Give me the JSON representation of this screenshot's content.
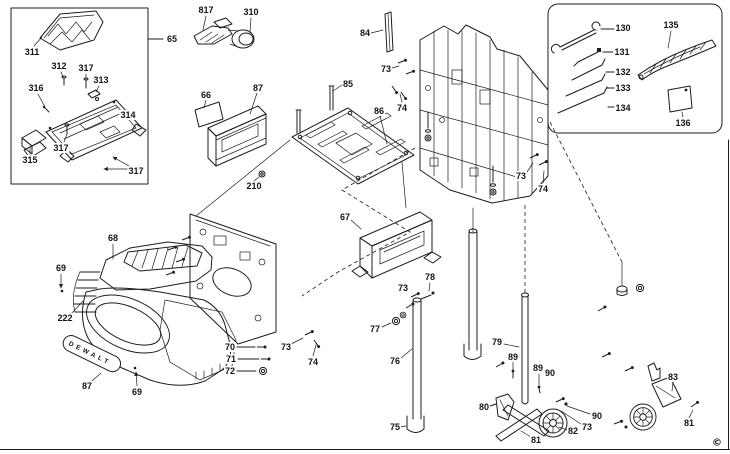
{
  "badge": {
    "text": "DEWALT"
  },
  "copyright": "©",
  "labels": [
    {
      "text": "311",
      "x": 32,
      "y": 52
    },
    {
      "text": "312",
      "x": 59,
      "y": 66
    },
    {
      "text": "317",
      "x": 86,
      "y": 68
    },
    {
      "text": "313",
      "x": 101,
      "y": 80
    },
    {
      "text": "316",
      "x": 36,
      "y": 88
    },
    {
      "text": "314",
      "x": 128,
      "y": 115
    },
    {
      "text": "317",
      "x": 61,
      "y": 148
    },
    {
      "text": "315",
      "x": 30,
      "y": 160
    },
    {
      "text": "317",
      "x": 136,
      "y": 171
    },
    {
      "text": "65",
      "x": 172,
      "y": 39
    },
    {
      "text": "817",
      "x": 206,
      "y": 10
    },
    {
      "text": "310",
      "x": 251,
      "y": 12
    },
    {
      "text": "66",
      "x": 206,
      "y": 95
    },
    {
      "text": "87",
      "x": 258,
      "y": 88
    },
    {
      "text": "210",
      "x": 254,
      "y": 186
    },
    {
      "text": "84",
      "x": 365,
      "y": 33
    },
    {
      "text": "85",
      "x": 348,
      "y": 84
    },
    {
      "text": "86",
      "x": 379,
      "y": 111
    },
    {
      "text": "73",
      "x": 386,
      "y": 69
    },
    {
      "text": "74",
      "x": 402,
      "y": 108
    },
    {
      "text": "73",
      "x": 521,
      "y": 176
    },
    {
      "text": "74",
      "x": 543,
      "y": 189
    },
    {
      "text": "130",
      "x": 623,
      "y": 28
    },
    {
      "text": "135",
      "x": 671,
      "y": 25
    },
    {
      "text": "131",
      "x": 622,
      "y": 52
    },
    {
      "text": "132",
      "x": 623,
      "y": 72
    },
    {
      "text": "133",
      "x": 623,
      "y": 88
    },
    {
      "text": "134",
      "x": 623,
      "y": 108
    },
    {
      "text": "136",
      "x": 683,
      "y": 123
    },
    {
      "text": "67",
      "x": 345,
      "y": 217
    },
    {
      "text": "68",
      "x": 113,
      "y": 238
    },
    {
      "text": "69",
      "x": 61,
      "y": 268
    },
    {
      "text": "222",
      "x": 65,
      "y": 318
    },
    {
      "text": "87",
      "x": 87,
      "y": 386
    },
    {
      "text": "69",
      "x": 137,
      "y": 392
    },
    {
      "text": "70",
      "x": 230,
      "y": 347
    },
    {
      "text": "71",
      "x": 231,
      "y": 359
    },
    {
      "text": "72",
      "x": 230,
      "y": 371
    },
    {
      "text": "73",
      "x": 286,
      "y": 347
    },
    {
      "text": "74",
      "x": 313,
      "y": 362
    },
    {
      "text": "73",
      "x": 403,
      "y": 288
    },
    {
      "text": "78",
      "x": 430,
      "y": 277
    },
    {
      "text": "77",
      "x": 375,
      "y": 329
    },
    {
      "text": "76",
      "x": 395,
      "y": 361
    },
    {
      "text": "75",
      "x": 395,
      "y": 427
    },
    {
      "text": "79",
      "x": 497,
      "y": 342
    },
    {
      "text": "89",
      "x": 513,
      "y": 357
    },
    {
      "text": "89",
      "x": 538,
      "y": 368
    },
    {
      "text": "90",
      "x": 550,
      "y": 373
    },
    {
      "text": "80",
      "x": 484,
      "y": 407
    },
    {
      "text": "81",
      "x": 536,
      "y": 440
    },
    {
      "text": "82",
      "x": 573,
      "y": 431
    },
    {
      "text": "73",
      "x": 587,
      "y": 427
    },
    {
      "text": "90",
      "x": 597,
      "y": 416
    },
    {
      "text": "83",
      "x": 673,
      "y": 377
    },
    {
      "text": "81",
      "x": 689,
      "y": 423
    }
  ]
}
